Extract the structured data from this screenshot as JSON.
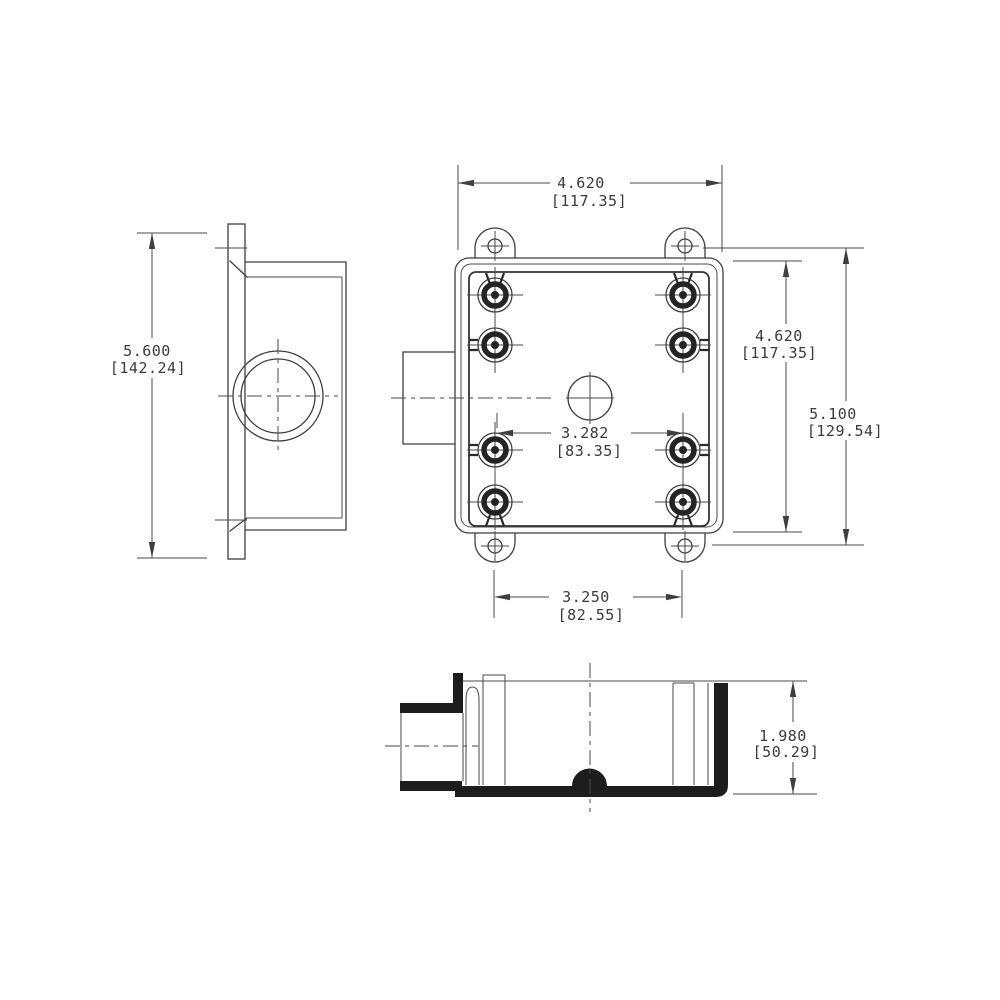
{
  "drawing": {
    "type": "engineering-dimension-drawing",
    "subject": "two-gang FS device box with side conduit hub (front, side and bottom-section views)",
    "dimensions": {
      "side_height": {
        "value": "5.600",
        "metric": "[142.24]"
      },
      "front_width": {
        "value": "4.620",
        "metric": "[117.35]"
      },
      "front_height": {
        "value": "4.620",
        "metric": "[117.35]"
      },
      "overall_height": {
        "value": "5.100",
        "metric": "[129.54]"
      },
      "device_screw_spacing": {
        "value": "3.282",
        "metric": "[83.35]"
      },
      "lug_spacing": {
        "value": "3.250",
        "metric": "[82.55]"
      },
      "box_depth": {
        "value": "1.980",
        "metric": "[50.29]"
      }
    },
    "colors": {
      "line": "#3f3f3f",
      "section_fill": "#1d1d1d",
      "text": "#3a3a3a",
      "background": "#ffffff"
    }
  }
}
